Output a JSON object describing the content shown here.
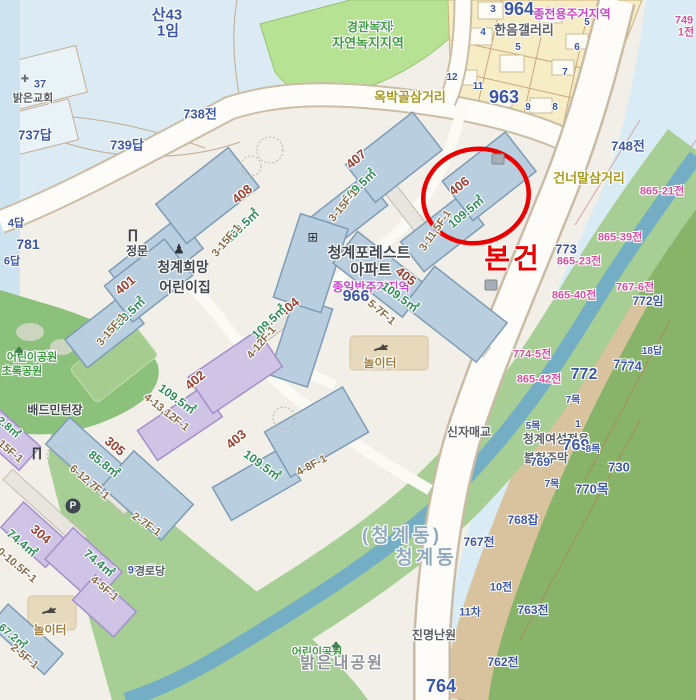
{
  "subject": {
    "label": "본건",
    "x": 513,
    "y": 259,
    "size": 28,
    "color": "#e90000",
    "circle": {
      "cx": 476,
      "cy": 196,
      "rx": 53,
      "ry": 47,
      "rot": -12,
      "width": 4.5
    }
  },
  "colors": {
    "subject_red": "#e90000",
    "parcel_blue": "#3c57a6",
    "parcel_pink": "#d8519e",
    "zone_green": "#3f9b41",
    "zone_magenta": "#cc44cc",
    "road_label_olive": "#a89b1f",
    "building_fill_blue": "#b9cfdf",
    "building_fill_purple": "#cfc3e6",
    "hill_blue": "#dcebf3",
    "veg_green": "#a7ce94",
    "river_teal": "#73aec5",
    "block_yellow": "#f6ecc6"
  },
  "icon_glyphs": {
    "church": "✚",
    "gate": "∏",
    "person": "♟",
    "apt": "⊞",
    "tree": "♣",
    "parking": "P",
    "marker": "",
    "seesaw": ""
  },
  "icons": [
    {
      "k": "church",
      "x": 25,
      "y": 80,
      "n": "church-icon"
    },
    {
      "k": "gate",
      "x": 133,
      "y": 234,
      "n": "main-gate-icon"
    },
    {
      "k": "gate",
      "x": 37,
      "y": 452,
      "n": "gate-icon"
    },
    {
      "k": "person",
      "x": 179,
      "y": 249,
      "n": "daycare-icon"
    },
    {
      "k": "apt",
      "x": 313,
      "y": 237,
      "n": "apartment-icon"
    },
    {
      "k": "tree",
      "x": 19,
      "y": 350,
      "n": "park-tree-icon"
    },
    {
      "k": "tree",
      "x": 336,
      "y": 645,
      "n": "park-tree-icon"
    },
    {
      "k": "parking",
      "x": 73,
      "y": 506,
      "n": "parking-icon"
    },
    {
      "k": "marker",
      "x": 498,
      "y": 159,
      "n": "map-marker-icon"
    },
    {
      "k": "marker",
      "x": 491,
      "y": 285,
      "n": "map-marker-icon"
    },
    {
      "k": "seesaw",
      "x": 381,
      "y": 350,
      "n": "playground-icon"
    },
    {
      "k": "seesaw",
      "x": 49,
      "y": 613,
      "n": "playground-icon"
    }
  ],
  "labels": [
    {
      "t": "산43",
      "x": 167,
      "y": 15,
      "c": "pb",
      "s": 15
    },
    {
      "t": "1임",
      "x": 168,
      "y": 31,
      "c": "pb",
      "s": 15
    },
    {
      "t": "37",
      "x": 40,
      "y": 85,
      "c": "pb",
      "s": 11
    },
    {
      "t": "밝은교회",
      "x": 33,
      "y": 99,
      "c": "ng",
      "s": 11
    },
    {
      "t": "737답",
      "x": 35,
      "y": 135,
      "c": "pb",
      "s": 13
    },
    {
      "t": "739답",
      "x": 127,
      "y": 145,
      "c": "pb",
      "s": 13
    },
    {
      "t": "738전",
      "x": 200,
      "y": 114,
      "c": "pb",
      "s": 13
    },
    {
      "t": "4답",
      "x": 16,
      "y": 224,
      "c": "pb",
      "s": 11
    },
    {
      "t": "781",
      "x": 28,
      "y": 244,
      "c": "pb",
      "s": 14
    },
    {
      "t": "6답",
      "x": 12,
      "y": 262,
      "c": "pb",
      "s": 11
    },
    {
      "t": "965공",
      "x": 378,
      "y": 26,
      "c": "pb",
      "s": 12
    },
    {
      "t": "경관녹지",
      "x": 369,
      "y": 27,
      "c": "zg",
      "s": 12
    },
    {
      "t": "자연녹지지역",
      "x": 368,
      "y": 43,
      "c": "zg",
      "s": 13
    },
    {
      "t": "964",
      "x": 519,
      "y": 9,
      "c": "pb",
      "s": 18
    },
    {
      "t": "종전용주거지역",
      "x": 572,
      "y": 14,
      "c": "zm",
      "s": 12
    },
    {
      "t": "한음갤러리",
      "x": 524,
      "y": 30,
      "c": "ng",
      "s": 13
    },
    {
      "t": "3",
      "x": 493,
      "y": 10,
      "c": "pb",
      "s": 10
    },
    {
      "t": "4",
      "x": 483,
      "y": 33,
      "c": "pb",
      "s": 10
    },
    {
      "t": "5",
      "x": 518,
      "y": 48,
      "c": "pb",
      "s": 10
    },
    {
      "t": "5",
      "x": 587,
      "y": 23,
      "c": "pb",
      "s": 10
    },
    {
      "t": "6",
      "x": 577,
      "y": 48,
      "c": "pb",
      "s": 10
    },
    {
      "t": "7",
      "x": 565,
      "y": 73,
      "c": "pb",
      "s": 10
    },
    {
      "t": "12",
      "x": 452,
      "y": 78,
      "c": "pb",
      "s": 10
    },
    {
      "t": "11",
      "x": 478,
      "y": 87,
      "c": "pb",
      "s": 10
    },
    {
      "t": "963",
      "x": 504,
      "y": 97,
      "c": "pb",
      "s": 18
    },
    {
      "t": "9",
      "x": 528,
      "y": 108,
      "c": "pb",
      "s": 10
    },
    {
      "t": "8",
      "x": 555,
      "y": 108,
      "c": "pb",
      "s": 10
    },
    {
      "t": "749",
      "x": 684,
      "y": 21,
      "c": "pk",
      "s": 11
    },
    {
      "t": "1전",
      "x": 686,
      "y": 33,
      "c": "pk",
      "s": 11
    },
    {
      "t": "옥박골삼거리",
      "x": 410,
      "y": 97,
      "c": "ro",
      "s": 13
    },
    {
      "t": "건너말삼거리",
      "x": 589,
      "y": 178,
      "c": "ro",
      "s": 13
    },
    {
      "t": "748전",
      "x": 628,
      "y": 146,
      "c": "pb",
      "s": 13
    },
    {
      "t": "865-21전",
      "x": 662,
      "y": 192,
      "c": "pk",
      "s": 11
    },
    {
      "t": "865-39전",
      "x": 620,
      "y": 238,
      "c": "pk",
      "s": 11
    },
    {
      "t": "773",
      "x": 566,
      "y": 249,
      "c": "pb",
      "s": 13
    },
    {
      "t": "865-23전",
      "x": 579,
      "y": 262,
      "c": "pk",
      "s": 11
    },
    {
      "t": "865-40전",
      "x": 574,
      "y": 296,
      "c": "pk",
      "s": 11
    },
    {
      "t": "767-6전",
      "x": 635,
      "y": 288,
      "c": "pk",
      "s": 11
    },
    {
      "t": "772임",
      "x": 648,
      "y": 301,
      "c": "pb",
      "s": 12
    },
    {
      "t": "774-5전",
      "x": 532,
      "y": 355,
      "c": "pk",
      "s": 11
    },
    {
      "t": "865-42전",
      "x": 539,
      "y": 380,
      "c": "pk",
      "s": 11
    },
    {
      "t": "18답",
      "x": 652,
      "y": 352,
      "c": "pb",
      "s": 10
    },
    {
      "t": "772",
      "x": 584,
      "y": 375,
      "c": "pb",
      "s": 16
    },
    {
      "t": "771",
      "x": 624,
      "y": 364,
      "c": "pb",
      "s": 13
    },
    {
      "t": "774",
      "x": 631,
      "y": 366,
      "c": "pb",
      "s": 13
    },
    {
      "t": "7목",
      "x": 573,
      "y": 401,
      "c": "pb",
      "s": 10
    },
    {
      "t": "청계여성전용",
      "x": 556,
      "y": 439,
      "c": "ng",
      "s": 12
    },
    {
      "t": "769",
      "x": 576,
      "y": 446,
      "c": "pb",
      "s": 16
    },
    {
      "t": "불헌주막",
      "x": 546,
      "y": 458,
      "c": "ng",
      "s": 12
    },
    {
      "t": "769",
      "x": 540,
      "y": 462,
      "c": "pb",
      "s": 12
    },
    {
      "t": "5목",
      "x": 533,
      "y": 427,
      "c": "pb",
      "s": 10
    },
    {
      "t": "1",
      "x": 578,
      "y": 425,
      "c": "pb",
      "s": 10
    },
    {
      "t": "8목",
      "x": 593,
      "y": 450,
      "c": "pb",
      "s": 10
    },
    {
      "t": "7목",
      "x": 552,
      "y": 485,
      "c": "pb",
      "s": 10
    },
    {
      "t": "770목",
      "x": 592,
      "y": 489,
      "c": "pb",
      "s": 13
    },
    {
      "t": "730",
      "x": 619,
      "y": 467,
      "c": "pb",
      "s": 13
    },
    {
      "t": "768잡",
      "x": 523,
      "y": 520,
      "c": "pb",
      "s": 12
    },
    {
      "t": "767전",
      "x": 479,
      "y": 542,
      "c": "pb",
      "s": 12
    },
    {
      "t": "10전",
      "x": 501,
      "y": 588,
      "c": "pb",
      "s": 11
    },
    {
      "t": "11차",
      "x": 470,
      "y": 613,
      "c": "pb",
      "s": 11
    },
    {
      "t": "763전",
      "x": 533,
      "y": 610,
      "c": "pb",
      "s": 12
    },
    {
      "t": "진명난원",
      "x": 434,
      "y": 635,
      "c": "ng",
      "s": 12
    },
    {
      "t": "762전",
      "x": 503,
      "y": 662,
      "c": "pb",
      "s": 12
    },
    {
      "t": "764",
      "x": 441,
      "y": 686,
      "c": "pb",
      "s": 18
    },
    {
      "t": "신자매교",
      "x": 469,
      "y": 432,
      "c": "ng",
      "s": 12
    },
    {
      "t": "(청계동)",
      "x": 402,
      "y": 536,
      "c": "ab",
      "s": 19
    },
    {
      "t": "청계동",
      "x": 426,
      "y": 558,
      "c": "ab",
      "s": 19
    },
    {
      "t": "청계포레스트",
      "x": 369,
      "y": 253,
      "c": "nd",
      "s": 15
    },
    {
      "t": "아파트",
      "x": 371,
      "y": 270,
      "c": "nd",
      "s": 15
    },
    {
      "t": "종일반주거지역",
      "x": 371,
      "y": 287,
      "c": "zm",
      "s": 12
    },
    {
      "t": "966",
      "x": 356,
      "y": 297,
      "c": "pb",
      "s": 16
    },
    {
      "t": "청계희망",
      "x": 183,
      "y": 267,
      "c": "nd",
      "s": 14
    },
    {
      "t": "어린이집",
      "x": 185,
      "y": 287,
      "c": "nd",
      "s": 14
    },
    {
      "t": "정문",
      "x": 137,
      "y": 251,
      "c": "nd",
      "s": 12
    },
    {
      "t": "놀이터",
      "x": 380,
      "y": 363,
      "c": "nt",
      "s": 12
    },
    {
      "t": "놀이터",
      "x": 50,
      "y": 630,
      "c": "nt",
      "s": 12
    },
    {
      "t": "배드민턴장",
      "x": 55,
      "y": 410,
      "c": "nd",
      "s": 12
    },
    {
      "t": "967공",
      "x": 41,
      "y": 357,
      "c": "pb",
      "s": 11
    },
    {
      "t": "어린이공원",
      "x": 32,
      "y": 358,
      "c": "zg",
      "s": 11
    },
    {
      "t": "초록공원",
      "x": 22,
      "y": 372,
      "c": "zg",
      "s": 11
    },
    {
      "t": "870공",
      "x": 324,
      "y": 652,
      "c": "pb",
      "s": 11
    },
    {
      "t": "어린이공원",
      "x": 317,
      "y": 653,
      "c": "zg",
      "s": 11
    },
    {
      "t": "밝은내공원",
      "x": 342,
      "y": 664,
      "c": "nl",
      "s": 16
    },
    {
      "t": "958공",
      "x": 142,
      "y": 571,
      "c": "pb",
      "s": 11
    },
    {
      "t": "경로당",
      "x": 150,
      "y": 572,
      "c": "ng",
      "s": 11
    },
    {
      "t": "408",
      "x": 242,
      "y": 194,
      "c": "bn",
      "r": -40,
      "s": 13
    },
    {
      "t": "109.5㎡",
      "x": 242,
      "y": 226,
      "c": "ba",
      "r": -44,
      "s": 12
    },
    {
      "t": "3-15F-1",
      "x": 227,
      "y": 241,
      "c": "bf",
      "r": -50,
      "s": 11
    },
    {
      "t": "407",
      "x": 356,
      "y": 159,
      "c": "bn",
      "r": -40,
      "s": 13
    },
    {
      "t": "109.5㎡",
      "x": 359,
      "y": 186,
      "c": "ba",
      "r": -44,
      "s": 12
    },
    {
      "t": "3-15F-1",
      "x": 344,
      "y": 206,
      "c": "bf",
      "r": -50,
      "s": 11
    },
    {
      "t": "406",
      "x": 459,
      "y": 186,
      "c": "bn",
      "r": -38,
      "s": 13
    },
    {
      "t": "109.5㎡",
      "x": 466,
      "y": 212,
      "c": "ba",
      "r": -40,
      "s": 12
    },
    {
      "t": "3-11,5F-1",
      "x": 436,
      "y": 231,
      "c": "bf",
      "r": -55,
      "s": 11
    },
    {
      "t": "401",
      "x": 125,
      "y": 285,
      "c": "bn",
      "r": -40,
      "s": 13
    },
    {
      "t": "109.5㎡",
      "x": 128,
      "y": 314,
      "c": "ba",
      "r": -44,
      "s": 12
    },
    {
      "t": "3-15F-1",
      "x": 112,
      "y": 330,
      "c": "bf",
      "r": -50,
      "s": 11
    },
    {
      "t": "404",
      "x": 289,
      "y": 307,
      "c": "bn",
      "r": -40,
      "s": 13
    },
    {
      "t": "109.5㎡",
      "x": 269,
      "y": 322,
      "c": "ba",
      "r": -44,
      "s": 12
    },
    {
      "t": "4-12F-1",
      "x": 262,
      "y": 343,
      "c": "bf",
      "r": -50,
      "s": 11
    },
    {
      "t": "405",
      "x": 406,
      "y": 276,
      "c": "bn",
      "r": 38,
      "s": 13
    },
    {
      "t": "109.5㎡",
      "x": 400,
      "y": 297,
      "c": "ba",
      "r": 36,
      "s": 12
    },
    {
      "t": "5-7F-1",
      "x": 381,
      "y": 313,
      "c": "bf",
      "r": 40,
      "s": 11
    },
    {
      "t": "403",
      "x": 236,
      "y": 439,
      "c": "bn",
      "r": -40,
      "s": 13
    },
    {
      "t": "109.5㎡",
      "x": 262,
      "y": 465,
      "c": "ba",
      "r": 36,
      "s": 12
    },
    {
      "t": "4-8F-1",
      "x": 312,
      "y": 466,
      "c": "bf",
      "r": -28,
      "s": 11
    },
    {
      "t": "402",
      "x": 195,
      "y": 380,
      "c": "bn",
      "r": -40,
      "s": 13
    },
    {
      "t": "109.5㎡",
      "x": 177,
      "y": 399,
      "c": "ba",
      "r": 36,
      "s": 12
    },
    {
      "t": "4-13,12F-1",
      "x": 166,
      "y": 413,
      "c": "bf",
      "r": 38,
      "s": 11
    },
    {
      "t": "305",
      "x": 115,
      "y": 446,
      "c": "bn",
      "r": 40,
      "s": 13
    },
    {
      "t": "85.8㎡",
      "x": 104,
      "y": 464,
      "c": "ba",
      "r": 38,
      "s": 12
    },
    {
      "t": "6-12,7F-1",
      "x": 89,
      "y": 483,
      "c": "bf",
      "r": 40,
      "s": 11
    },
    {
      "t": "2-7F-1",
      "x": 146,
      "y": 525,
      "c": "bf",
      "r": 35,
      "s": 11
    },
    {
      "t": "304",
      "x": 41,
      "y": 534,
      "c": "bn",
      "r": 40,
      "s": 13
    },
    {
      "t": "74.4㎡",
      "x": 22,
      "y": 543,
      "c": "ba",
      "r": 40,
      "s": 12
    },
    {
      "t": "10-10.5F-1",
      "x": 14,
      "y": 564,
      "c": "bf",
      "r": 40,
      "s": 11
    },
    {
      "t": "74.4㎡",
      "x": 99,
      "y": 563,
      "c": "ba",
      "r": 40,
      "s": 12
    },
    {
      "t": "4-5F-1",
      "x": 104,
      "y": 589,
      "c": "bf",
      "r": 40,
      "s": 11
    },
    {
      "t": "2.8㎡",
      "x": 8,
      "y": 428,
      "c": "ba",
      "r": 40,
      "s": 11
    },
    {
      "t": "15F-1",
      "x": 10,
      "y": 452,
      "c": "bf",
      "r": 40,
      "s": 11
    },
    {
      "t": "67.2㎡",
      "x": 12,
      "y": 637,
      "c": "ba",
      "r": 40,
      "s": 11
    },
    {
      "t": "2-5F-1",
      "x": 24,
      "y": 657,
      "c": "bf",
      "r": 40,
      "s": 11
    }
  ]
}
